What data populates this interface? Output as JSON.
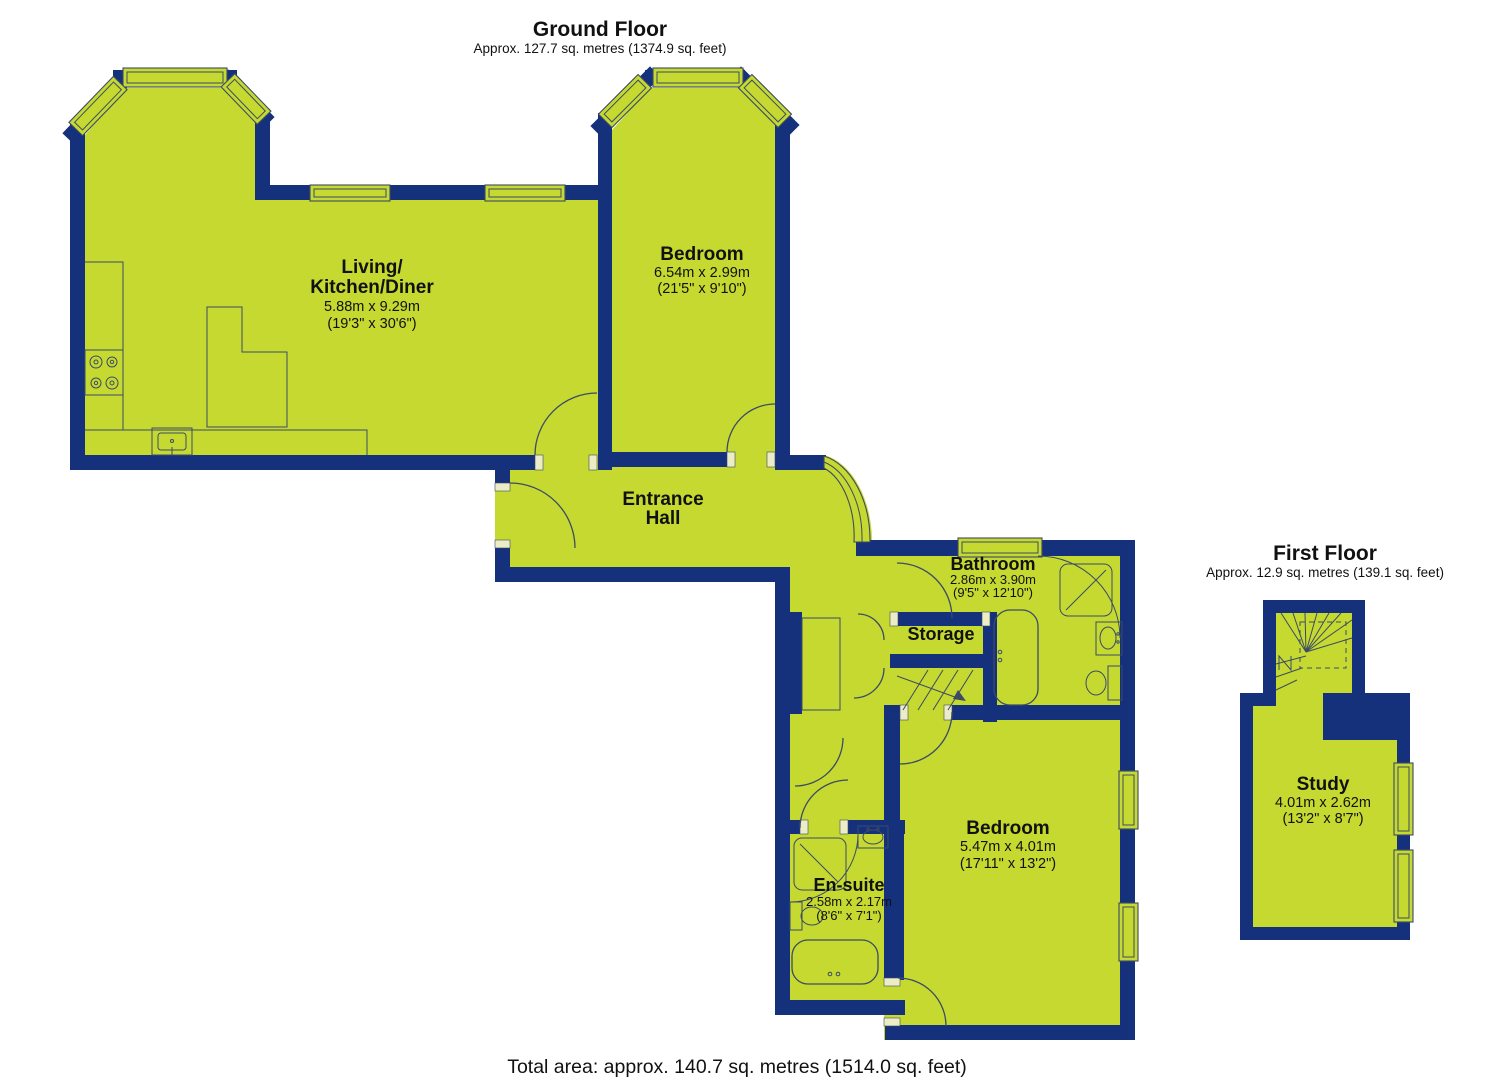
{
  "colors": {
    "floor": "#c5d931",
    "wall": "#16317b",
    "fixture_outline": "#3c4b66",
    "label_text": "#111111",
    "jamb": "#ecedc6",
    "background": "#ffffff"
  },
  "ground_floor": {
    "title": "Ground Floor",
    "subtitle": "Approx. 127.7 sq. metres (1374.9 sq. feet)",
    "rooms": {
      "living_kitchen_diner": {
        "line1": "Living/",
        "line2": "Kitchen/Diner",
        "metric": "5.88m x 9.29m",
        "imperial": "(19'3\" x 30'6\")"
      },
      "bedroom_top": {
        "name": "Bedroom",
        "metric": "6.54m x 2.99m",
        "imperial": "(21'5\" x 9'10\")"
      },
      "entrance_hall": {
        "line1": "Entrance",
        "line2": "Hall"
      },
      "bathroom": {
        "name": "Bathroom",
        "metric": "2.86m x 3.90m",
        "imperial": "(9'5\" x 12'10\")"
      },
      "storage": {
        "name": "Storage"
      },
      "bedroom_bottom": {
        "name": "Bedroom",
        "metric": "5.47m x 4.01m",
        "imperial": "(17'11\" x 13'2\")"
      },
      "en_suite": {
        "name": "En-suite",
        "metric": "2.58m x 2.17m",
        "imperial": "(8'6\" x 7'1\")"
      }
    }
  },
  "first_floor": {
    "title": "First Floor",
    "subtitle": "Approx. 12.9 sq. metres (139.1 sq. feet)",
    "rooms": {
      "study": {
        "name": "Study",
        "metric": "4.01m x 2.62m",
        "imperial": "(13'2\" x 8'7\")"
      }
    }
  },
  "footer": {
    "total_area": "Total area: approx. 140.7 sq. metres (1514.0 sq. feet)"
  }
}
